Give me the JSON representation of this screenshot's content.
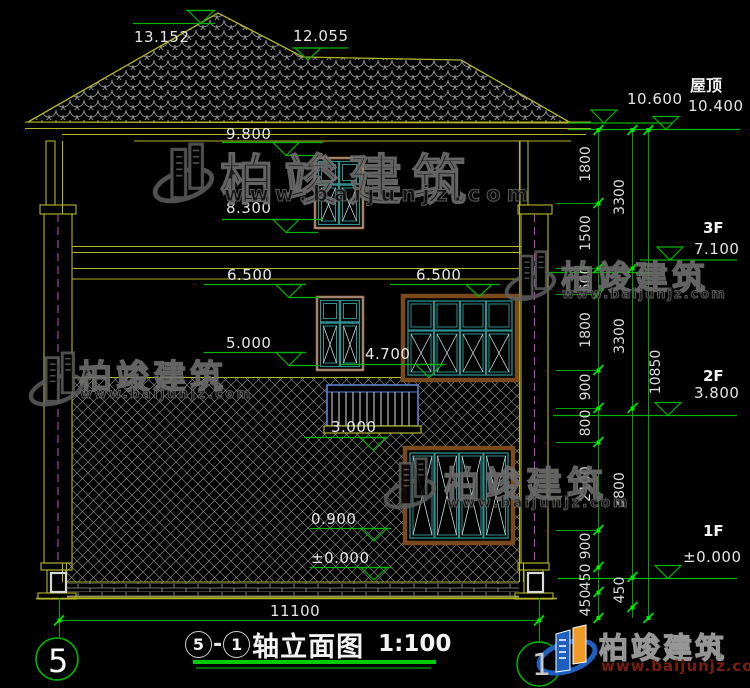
{
  "title_block": {
    "axis_from": "5",
    "separator": "-",
    "axis_to": "1",
    "title": "轴立面图",
    "scale": "1:100"
  },
  "grid_bubbles": {
    "left": "5",
    "right": "1"
  },
  "levels_left": [
    "13.152",
    "12.055",
    "9.800",
    "8.300",
    "6.500",
    "6.500",
    "5.000",
    "4.700",
    "3.000",
    "0.900",
    "±0.000"
  ],
  "levels_right": {
    "roof_label": "屋顶",
    "roof_upper": "10.600",
    "roof": "10.400",
    "f3_label": "3F",
    "f3": "7.100",
    "f2_label": "2F",
    "f2": "3.800",
    "f1_label": "1F",
    "f1": "±0.000"
  },
  "dims": {
    "chain_inner": [
      "1800",
      "1500",
      "600",
      "1800",
      "900",
      "800",
      "2100",
      "900",
      "450",
      "450"
    ],
    "chain_mid": [
      "3300",
      "3300",
      "3800",
      "450"
    ],
    "total": "10850",
    "width": "11100"
  },
  "watermark": {
    "brand": "柏竣建筑",
    "url": "www.baijunjz.com"
  },
  "logo": {
    "brand": "柏竣建筑",
    "url": "www.baijunjz.com"
  },
  "colors": {
    "background": "#000000",
    "line_yellow": "#b5b52a",
    "line_green": "#00b400",
    "grip_green": "#00ee00",
    "window_teal": "#2e8f8f",
    "frame_brown": "#7a4a1e",
    "centerline_magenta": "#b050b0",
    "text_white": "#e6e6e6",
    "logo_blue": "#1f5fc0",
    "logo_orange": "#f09a28"
  }
}
